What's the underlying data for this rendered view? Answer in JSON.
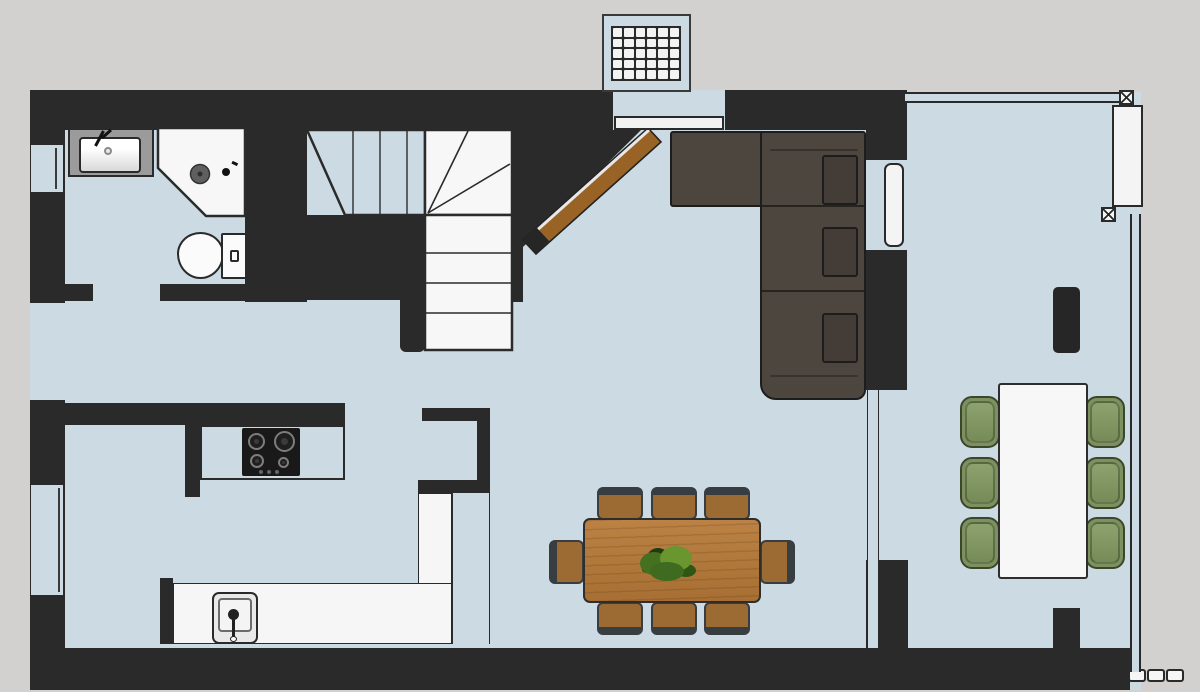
{
  "title": "residential-floor-plan",
  "colors": {
    "outside": "#d2d1cf",
    "floor": "#ccdbe3",
    "wall": "#2a2a2a",
    "white_fixture": "#f6f6f6",
    "counter_gray": "#9b9b9b",
    "sofa": "#4d463f",
    "sofa_cushion": "#443d37",
    "wood_table": "#b1793c",
    "wood_seat": "#9c6a33",
    "chair_frame": "#383d42",
    "green_chair": "#7d9060",
    "green_chair_border": "#3c462a",
    "ramp_brown": "#9a6326",
    "line": "#2a2a2a"
  },
  "entry": {
    "mat_cols": 6,
    "mat_rows": 5,
    "mat_cells": 30
  },
  "inventory": {
    "rooms": [
      "bathroom",
      "stair-hall",
      "kitchen",
      "living-area",
      "dining-area",
      "conservatory",
      "entry"
    ],
    "fixtures": [
      "bathroom-sink",
      "corner-shower",
      "toilet",
      "kitchen-cooktop",
      "kitchen-sink",
      "entry-grate-mat",
      "winder-staircase",
      "sloped-ramp"
    ],
    "furniture": [
      "l-shaped-sofa",
      "sofa-back-cushions-x3",
      "wood-dining-table",
      "dining-chairs-x8",
      "plant-centerpiece",
      "conservatory-table",
      "green-chairs-x6",
      "floor-vent"
    ],
    "glazing": [
      "left-wall-windows-x3",
      "conservatory-glass-walls",
      "glass-partition",
      "corner-posts-x2",
      "bottom-wall-lights-x3"
    ]
  }
}
